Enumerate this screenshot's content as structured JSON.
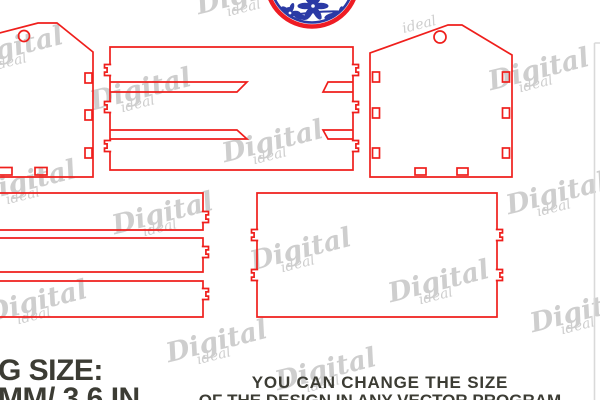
{
  "canvas": {
    "width": 600,
    "height": 400
  },
  "colors": {
    "background": "#ffffff",
    "outline_red": "#ef1f1c",
    "logo_blue": "#2b3aa5",
    "logo_red_ring": "#ee1c24",
    "watermark_gray": "#c6c6c6",
    "text_dark": "#3c3c34",
    "edge_line_gray": "#d9d9d9"
  },
  "texts": {
    "size_label": {
      "line1": "G SIZE:",
      "line2": "MM/ 3.6 IN"
    },
    "notice": {
      "line1": "YOU CAN CHANGE THE SIZE",
      "line2": "OF THE DESIGN IN ANY VECTOR PROGRAM"
    }
  },
  "watermark": {
    "word": "Digital",
    "subword": "ideal",
    "positions": [
      [
        -38,
        34
      ],
      [
        90,
        76
      ],
      [
        488,
        56
      ],
      [
        112,
        200
      ],
      [
        222,
        128
      ],
      [
        250,
        236
      ],
      [
        388,
        268
      ],
      [
        -14,
        288
      ],
      [
        506,
        180
      ],
      [
        530,
        298
      ],
      [
        166,
        328
      ],
      [
        275,
        356
      ],
      [
        -25,
        168
      ],
      [
        196,
        -20
      ],
      [
        402,
        18,
        "sub"
      ]
    ]
  },
  "logo": {
    "name": "blue-floral-badge"
  },
  "template_pieces": {
    "tab_profile": {
      "depth": 5.5,
      "height": 11,
      "notch_depth": 2.6,
      "notch_height": 4.2
    },
    "left_side_panel": {
      "outline": [
        [
          -16,
          37
        ],
        [
          38,
          23
        ],
        [
          57,
          23
        ],
        [
          93,
          52
        ],
        [
          93,
          177
        ],
        [
          -16,
          177
        ]
      ],
      "closed": false,
      "circle_hole": {
        "cx": 24,
        "cy": 36,
        "r": 5.5
      },
      "slot_holes": [
        {
          "x": 85,
          "y": 73,
          "w": 7,
          "h": 10
        },
        {
          "x": 85,
          "y": 110,
          "w": 7,
          "h": 10
        },
        {
          "x": 85,
          "y": 148,
          "w": 7,
          "h": 10
        },
        {
          "x": -3,
          "y": 167.5,
          "w": 15,
          "h": 7.5
        },
        {
          "x": 35,
          "y": 167.5,
          "w": 12,
          "h": 7.5
        }
      ]
    },
    "right_side_panel": {
      "outline": [
        [
          370,
          177
        ],
        [
          370,
          53
        ],
        [
          448,
          25
        ],
        [
          462,
          25
        ],
        [
          512,
          55
        ],
        [
          512,
          177
        ]
      ],
      "closed": true,
      "circle_hole": {
        "cx": 440,
        "cy": 37,
        "r": 6
      },
      "slot_holes": [
        {
          "x": 372.5,
          "y": 72,
          "w": 7,
          "h": 10
        },
        {
          "x": 372.5,
          "y": 108,
          "w": 7,
          "h": 10
        },
        {
          "x": 372.5,
          "y": 148,
          "w": 7,
          "h": 10
        },
        {
          "x": 502.5,
          "y": 72,
          "w": 7,
          "h": 10
        },
        {
          "x": 502.5,
          "y": 108,
          "w": 7,
          "h": 10
        },
        {
          "x": 502.5,
          "y": 148,
          "w": 7,
          "h": 10
        },
        {
          "x": 415,
          "y": 168,
          "w": 11,
          "h": 7
        },
        {
          "x": 457,
          "y": 168,
          "w": 11,
          "h": 7
        }
      ]
    },
    "top_wrap_panel": {
      "rect": {
        "x": 110,
        "y": 47,
        "w": 243,
        "h": 123
      },
      "tabs_left": [
        70,
        107,
        146
      ],
      "tabs_right": [
        70,
        107,
        146
      ],
      "slits": [
        {
          "y_top": 82,
          "y_bot": 92,
          "left": {
            "x1": 110,
            "top_x2": 247,
            "bot_x2": 237
          },
          "right": {
            "x2": 353,
            "top_x1": 328,
            "bot_x1": 323
          }
        },
        {
          "y_top": 130,
          "y_bot": 139,
          "left": {
            "x1": 110,
            "top_x2": 237,
            "bot_x2": 247
          },
          "right": {
            "x2": 353,
            "top_x1": 323,
            "bot_x1": 328
          }
        }
      ]
    },
    "bottom_panel": {
      "rect": {
        "x": 257,
        "y": 193,
        "w": 240,
        "h": 124
      },
      "tabs_left": [
        235,
        275
      ],
      "tabs_right": [
        235,
        275
      ]
    },
    "slats": [
      {
        "x1": -16,
        "x2": 203,
        "y_top": 193,
        "y_bot": 230,
        "tab_y": 217
      },
      {
        "x1": -16,
        "x2": 203,
        "y_top": 238,
        "y_bot": 272,
        "tab_y": 252
      },
      {
        "x1": -16,
        "x2": 203,
        "y_top": 281,
        "y_bot": 317,
        "tab_y": 294
      }
    ],
    "page_edge_line": {
      "x": 594.5,
      "y_top": 43,
      "y_bot": 400,
      "tick_x2": 600
    }
  }
}
